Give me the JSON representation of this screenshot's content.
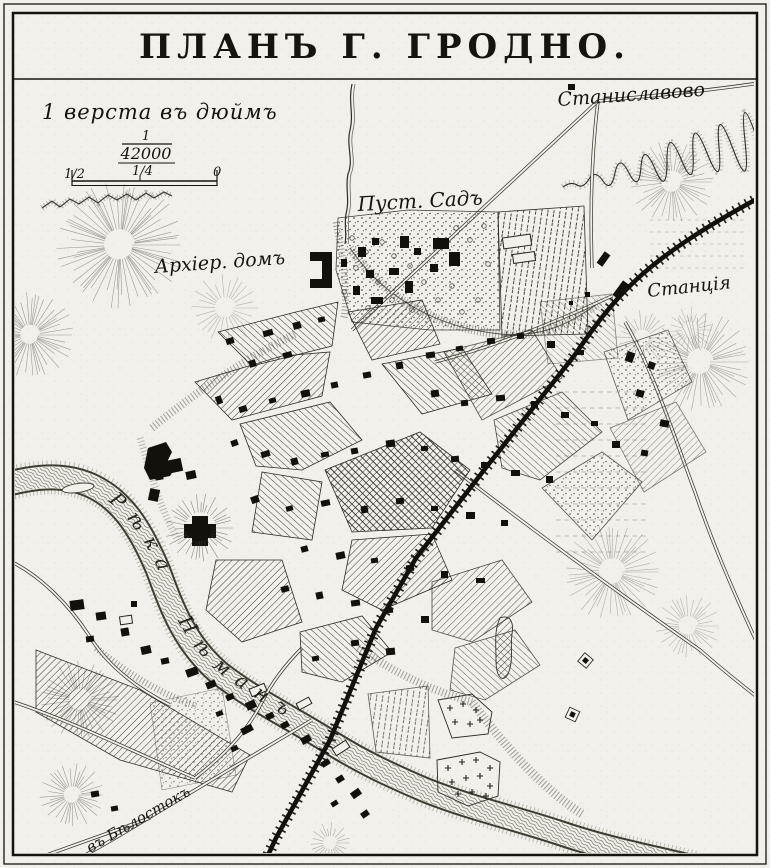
{
  "colors": {
    "paper": "#f2f0ea",
    "ink": "#17140e"
  },
  "map": {
    "title": "ПЛАНЪ Г. ГРОДНО.",
    "scale": {
      "caption": "1 верста въ дюймъ",
      "ratio_num": "1",
      "ratio_den": "42000",
      "bar_half": "1/2",
      "bar_quarter": "1/4",
      "bar_zero": "0"
    },
    "labels": {
      "stanislavovo": "Станиславово",
      "garden": "Пуст. Садъ",
      "bishops_house": "Архіер. домъ",
      "station": "Станція",
      "river": "Рѣка Нѣманъ",
      "bialystok_road": "въ Бѣлостокъ"
    }
  }
}
